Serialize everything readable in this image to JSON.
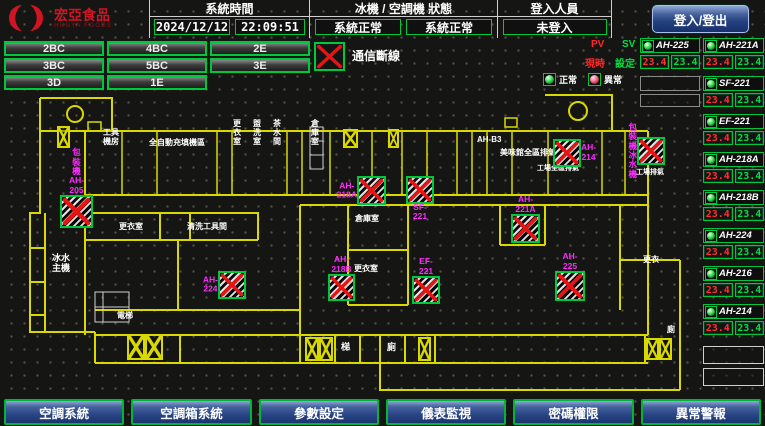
{
  "header": {
    "logo_name": "宏亞食品",
    "logo_sub": "HUNYA FOODS",
    "system_time": {
      "label": "系統時間",
      "date": "2024/12/12",
      "time": "22:09:51"
    },
    "machine_status": {
      "label": "冰機 / 空調機 狀態",
      "chiller_status": "系統正常",
      "ac_status": "系統正常"
    },
    "login": {
      "label": "登入人員",
      "value": "未登入",
      "button_label": "登入/登出"
    }
  },
  "floor_buttons": [
    "2BC",
    "4BC",
    "2E",
    "3BC",
    "5BC",
    "3E",
    "3D",
    "1E"
  ],
  "legend": {
    "comm_loss": "通信斷線",
    "pv": "PV",
    "sv": "SV",
    "current": "現時",
    "setpoint": "設定",
    "normal": "正常",
    "abnormal": "異常"
  },
  "colors": {
    "accent_green": "#00c83c",
    "alarm_red": "#e81414",
    "tag_magenta": "#ff2cff",
    "wall_yellow": "#d9d900",
    "button_blue": "#2a4685"
  },
  "units_left": {
    "items": [
      {
        "name": "AH-225",
        "pv": "23.4",
        "sv": "23.4"
      }
    ],
    "empty_slots": 2
  },
  "units_right": {
    "items": [
      {
        "name": "AH-221A",
        "pv": "23.4",
        "sv": "23.4"
      },
      {
        "name": "SF-221",
        "pv": "23.4",
        "sv": "23.4"
      },
      {
        "name": "EF-221",
        "pv": "23.4",
        "sv": "23.4"
      },
      {
        "name": "AH-218A",
        "pv": "23.4",
        "sv": "23.4"
      },
      {
        "name": "AH-218B",
        "pv": "23.4",
        "sv": "23.4"
      },
      {
        "name": "AH-224",
        "pv": "23.4",
        "sv": "23.4"
      },
      {
        "name": "AH-216",
        "pv": "23.4",
        "sv": "23.4"
      },
      {
        "name": "AH-214",
        "pv": "23.4",
        "sv": "23.4"
      }
    ],
    "empty_slots": 2
  },
  "menu": [
    "空調系統",
    "空調箱系統",
    "參數設定",
    "儀表監視",
    "密碼權限",
    "異常警報"
  ],
  "floor_plan": {
    "room_labels": [
      {
        "text": "工具\n機房",
        "x": 103,
        "y": 129,
        "fs": 8
      },
      {
        "text": "全自動充填機區",
        "x": 149,
        "y": 139,
        "fs": 8
      },
      {
        "text": "更\n衣\n室",
        "x": 233,
        "y": 120,
        "fs": 8
      },
      {
        "text": "盥\n洗\n室",
        "x": 253,
        "y": 120,
        "fs": 8
      },
      {
        "text": "茶\n水\n間",
        "x": 273,
        "y": 120,
        "fs": 8
      },
      {
        "text": "倉\n庫\n室",
        "x": 311,
        "y": 120,
        "fs": 8
      },
      {
        "text": "AH-B3",
        "x": 477,
        "y": 136,
        "fs": 8
      },
      {
        "text": "美味館全區排氣",
        "x": 500,
        "y": 149,
        "fs": 8,
        "w": 62
      },
      {
        "text": "工場全區排氣",
        "x": 537,
        "y": 165,
        "fs": 7
      },
      {
        "text": "工場排氣",
        "x": 636,
        "y": 169,
        "fs": 7,
        "w": 30
      },
      {
        "text": "更衣室",
        "x": 119,
        "y": 223,
        "fs": 8
      },
      {
        "text": "清洗工具間",
        "x": 187,
        "y": 223,
        "fs": 8
      },
      {
        "text": "倉庫室",
        "x": 355,
        "y": 215,
        "fs": 8
      },
      {
        "text": "更衣室",
        "x": 354,
        "y": 265,
        "fs": 8
      },
      {
        "text": "冰水\n主機",
        "x": 52,
        "y": 254,
        "fs": 9
      },
      {
        "text": "電梯",
        "x": 117,
        "y": 312,
        "fs": 8
      },
      {
        "text": "梯",
        "x": 341,
        "y": 343,
        "fs": 9
      },
      {
        "text": "廁",
        "x": 387,
        "y": 343,
        "fs": 9
      },
      {
        "text": "更衣",
        "x": 643,
        "y": 256,
        "fs": 8
      },
      {
        "text": "廁",
        "x": 667,
        "y": 326,
        "fs": 8
      }
    ],
    "comm_loss_marks": [
      {
        "x": 60,
        "y": 195,
        "s": 33,
        "label": "包裝機\nAH-205",
        "lp": "above"
      },
      {
        "x": 218,
        "y": 271,
        "s": 28,
        "label": "AH-224",
        "lp": "left"
      },
      {
        "x": 357,
        "y": 176,
        "s": 29,
        "label": "AH-218A",
        "lp": "left"
      },
      {
        "x": 406,
        "y": 176,
        "s": 28,
        "label": "SF-221",
        "lp": "below"
      },
      {
        "x": 328,
        "y": 274,
        "s": 27,
        "label": "AH-218B",
        "lp": "above"
      },
      {
        "x": 412,
        "y": 276,
        "s": 28,
        "label": "EF-221",
        "lp": "above"
      },
      {
        "x": 511,
        "y": 214,
        "s": 29,
        "label": "AH-221A",
        "lp": "above"
      },
      {
        "x": 555,
        "y": 271,
        "s": 30,
        "label": "AH-225",
        "lp": "above"
      },
      {
        "x": 553,
        "y": 139,
        "s": 28,
        "label": "AH-214",
        "lp": "right"
      },
      {
        "x": 637,
        "y": 137,
        "s": 28,
        "label": "包裝機\n冰水機",
        "lp": "left"
      }
    ],
    "stair_boxes": [
      {
        "x": 57,
        "y": 126,
        "w": 13,
        "h": 22
      },
      {
        "x": 343,
        "y": 129,
        "w": 15,
        "h": 19
      },
      {
        "x": 388,
        "y": 129,
        "w": 11,
        "h": 19
      },
      {
        "x": 127,
        "y": 334,
        "w": 18,
        "h": 26
      },
      {
        "x": 145,
        "y": 334,
        "w": 18,
        "h": 26
      },
      {
        "x": 305,
        "y": 337,
        "w": 14,
        "h": 24
      },
      {
        "x": 319,
        "y": 337,
        "w": 14,
        "h": 24
      },
      {
        "x": 418,
        "y": 337,
        "w": 13,
        "h": 24
      },
      {
        "x": 646,
        "y": 338,
        "w": 13,
        "h": 22
      },
      {
        "x": 659,
        "y": 338,
        "w": 13,
        "h": 22
      }
    ]
  }
}
